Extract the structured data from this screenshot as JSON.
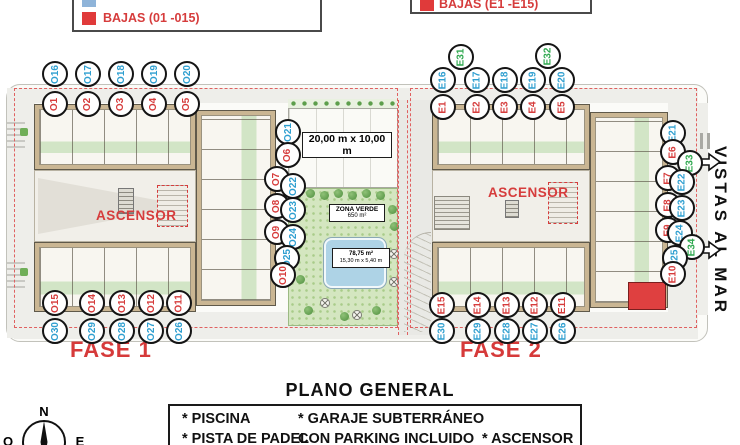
{
  "colors": {
    "red": "#d63c3c",
    "blue": "#2f9fd0",
    "green": "#2fa84f",
    "legend_blue": "#8fb4d9",
    "legend_red": "#e03a3a"
  },
  "legend_left": {
    "row2_label": "BAJAS (01 -015)"
  },
  "legend_top": {
    "label": "BAJAS (E1 -E15)"
  },
  "phase1": {
    "label": "FASE 1",
    "ascensor": "ASCENSOR"
  },
  "phase2": {
    "label": "FASE 2",
    "ascensor": "ASCENSOR"
  },
  "center": {
    "padel_dims": "20,00 m x 10,00 m",
    "zona_line1": "ZONA VERDE",
    "zona_line2": "650 m²",
    "pool_line1": "78,75 m²",
    "pool_line2": "15,30 m x 5,40 m"
  },
  "right_margin": {
    "vistas": "VISTAS AL MAR"
  },
  "footer": {
    "title": "PLANO GENERAL",
    "col1": [
      "* PISCINA",
      "* PISTA DE PADEL"
    ],
    "col2": [
      "* GARAJE SUBTERRÁNEO",
      "CON PARKING INCLUIDO"
    ],
    "col3": [
      "* ASCENSOR"
    ]
  },
  "compass": {
    "n": "N",
    "w": "O",
    "e": "E"
  },
  "units": [
    {
      "label": "O16",
      "color": "blue",
      "x": 55,
      "y": 74
    },
    {
      "label": "O17",
      "color": "blue",
      "x": 88,
      "y": 74
    },
    {
      "label": "O18",
      "color": "blue",
      "x": 121,
      "y": 74
    },
    {
      "label": "O19",
      "color": "blue",
      "x": 154,
      "y": 74
    },
    {
      "label": "O20",
      "color": "blue",
      "x": 187,
      "y": 74
    },
    {
      "label": "O1",
      "color": "red",
      "x": 55,
      "y": 104
    },
    {
      "label": "O2",
      "color": "red",
      "x": 88,
      "y": 104
    },
    {
      "label": "O3",
      "color": "red",
      "x": 121,
      "y": 104
    },
    {
      "label": "O4",
      "color": "red",
      "x": 154,
      "y": 104
    },
    {
      "label": "O5",
      "color": "red",
      "x": 187,
      "y": 104
    },
    {
      "label": "O21",
      "color": "blue",
      "x": 288,
      "y": 132
    },
    {
      "label": "O6",
      "color": "red",
      "x": 288,
      "y": 155
    },
    {
      "label": "O7",
      "color": "red",
      "x": 277,
      "y": 179
    },
    {
      "label": "O22",
      "color": "blue",
      "x": 293,
      "y": 186
    },
    {
      "label": "O8",
      "color": "red",
      "x": 277,
      "y": 206
    },
    {
      "label": "O23",
      "color": "blue",
      "x": 293,
      "y": 210
    },
    {
      "label": "O9",
      "color": "red",
      "x": 277,
      "y": 232
    },
    {
      "label": "O24",
      "color": "blue",
      "x": 293,
      "y": 237
    },
    {
      "label": "O25",
      "color": "blue",
      "x": 287,
      "y": 258
    },
    {
      "label": "O10",
      "color": "red",
      "x": 283,
      "y": 275
    },
    {
      "label": "O15",
      "color": "red",
      "x": 55,
      "y": 303
    },
    {
      "label": "O14",
      "color": "red",
      "x": 92,
      "y": 303
    },
    {
      "label": "O13",
      "color": "red",
      "x": 122,
      "y": 303
    },
    {
      "label": "O12",
      "color": "red",
      "x": 151,
      "y": 303
    },
    {
      "label": "O11",
      "color": "red",
      "x": 179,
      "y": 303
    },
    {
      "label": "O30",
      "color": "blue",
      "x": 55,
      "y": 331
    },
    {
      "label": "O29",
      "color": "blue",
      "x": 92,
      "y": 331
    },
    {
      "label": "O28",
      "color": "blue",
      "x": 122,
      "y": 331
    },
    {
      "label": "O27",
      "color": "blue",
      "x": 151,
      "y": 331
    },
    {
      "label": "O26",
      "color": "blue",
      "x": 179,
      "y": 331
    },
    {
      "label": "E31",
      "color": "green",
      "x": 461,
      "y": 57
    },
    {
      "label": "E32",
      "color": "green",
      "x": 548,
      "y": 56
    },
    {
      "label": "E16",
      "color": "blue",
      "x": 443,
      "y": 80
    },
    {
      "label": "E17",
      "color": "blue",
      "x": 477,
      "y": 80
    },
    {
      "label": "E18",
      "color": "blue",
      "x": 505,
      "y": 80
    },
    {
      "label": "E19",
      "color": "blue",
      "x": 533,
      "y": 80
    },
    {
      "label": "E20",
      "color": "blue",
      "x": 562,
      "y": 80
    },
    {
      "label": "E1",
      "color": "red",
      "x": 443,
      "y": 107
    },
    {
      "label": "E2",
      "color": "red",
      "x": 477,
      "y": 107
    },
    {
      "label": "E3",
      "color": "red",
      "x": 505,
      "y": 107
    },
    {
      "label": "E4",
      "color": "red",
      "x": 533,
      "y": 107
    },
    {
      "label": "E5",
      "color": "red",
      "x": 562,
      "y": 107
    },
    {
      "label": "E21",
      "color": "blue",
      "x": 673,
      "y": 133
    },
    {
      "label": "E6",
      "color": "red",
      "x": 673,
      "y": 152
    },
    {
      "label": "E33",
      "color": "green",
      "x": 690,
      "y": 163
    },
    {
      "label": "E7",
      "color": "red",
      "x": 668,
      "y": 178
    },
    {
      "label": "E22",
      "color": "blue",
      "x": 682,
      "y": 182
    },
    {
      "label": "E8",
      "color": "red",
      "x": 668,
      "y": 205
    },
    {
      "label": "E23",
      "color": "blue",
      "x": 682,
      "y": 208
    },
    {
      "label": "E9",
      "color": "red",
      "x": 668,
      "y": 230
    },
    {
      "label": "E24",
      "color": "blue",
      "x": 680,
      "y": 233
    },
    {
      "label": "E34",
      "color": "green",
      "x": 692,
      "y": 247
    },
    {
      "label": "E25",
      "color": "blue",
      "x": 675,
      "y": 258
    },
    {
      "label": "E10",
      "color": "red",
      "x": 673,
      "y": 274
    },
    {
      "label": "E15",
      "color": "red",
      "x": 442,
      "y": 305
    },
    {
      "label": "E14",
      "color": "red",
      "x": 478,
      "y": 305
    },
    {
      "label": "E13",
      "color": "red",
      "x": 507,
      "y": 305
    },
    {
      "label": "E12",
      "color": "red",
      "x": 535,
      "y": 305
    },
    {
      "label": "E11",
      "color": "red",
      "x": 563,
      "y": 305
    },
    {
      "label": "E30",
      "color": "blue",
      "x": 442,
      "y": 331
    },
    {
      "label": "E29",
      "color": "blue",
      "x": 478,
      "y": 331
    },
    {
      "label": "E28",
      "color": "blue",
      "x": 507,
      "y": 331
    },
    {
      "label": "E27",
      "color": "blue",
      "x": 535,
      "y": 331
    },
    {
      "label": "E26",
      "color": "blue",
      "x": 563,
      "y": 331
    }
  ]
}
